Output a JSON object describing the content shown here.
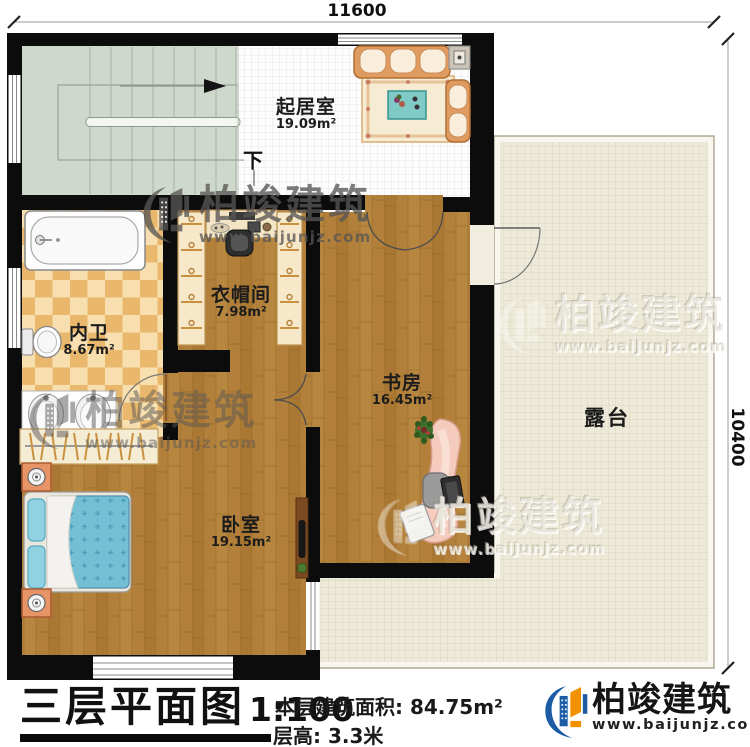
{
  "dimensions": {
    "top": "11600",
    "right": "10400"
  },
  "rooms": [
    {
      "name": "起居室",
      "area": "19.09m²"
    },
    {
      "name": "衣帽间",
      "area": "7.98m²"
    },
    {
      "name": "内卫",
      "area": "8.67m²"
    },
    {
      "name": "书房",
      "area": "16.45m²"
    },
    {
      "name": "卧室",
      "area": "19.15m²"
    },
    {
      "name": "露台",
      "area": ""
    }
  ],
  "stairs": {
    "direction_label": "下"
  },
  "title_block": {
    "title": "三层平面图",
    "scale": "1:100",
    "floor_area": "本层建筑面积: 84.75m²",
    "floor_height": "层高: 3.3米"
  },
  "brand": {
    "name": "柏竣建筑",
    "website": "www.baijunjz.com"
  },
  "watermark": {
    "name": "柏竣建筑",
    "website": "www.baijunjz.com"
  },
  "colors": {
    "wall": "#0c0c0c",
    "wood_floor": "#b2803a",
    "stair_floor": "#cfd8cd",
    "tile_floor": "#fdfdfd",
    "terrace_floor": "#edead9",
    "checker_light": "#f7dfb0",
    "checker_dark": "#eab86d",
    "bed": "#75bfd5",
    "sofa": "#df9b60",
    "desk": "#f4cbbc",
    "brand_blue": "#1c5ca5",
    "brand_orange": "#f29200"
  }
}
